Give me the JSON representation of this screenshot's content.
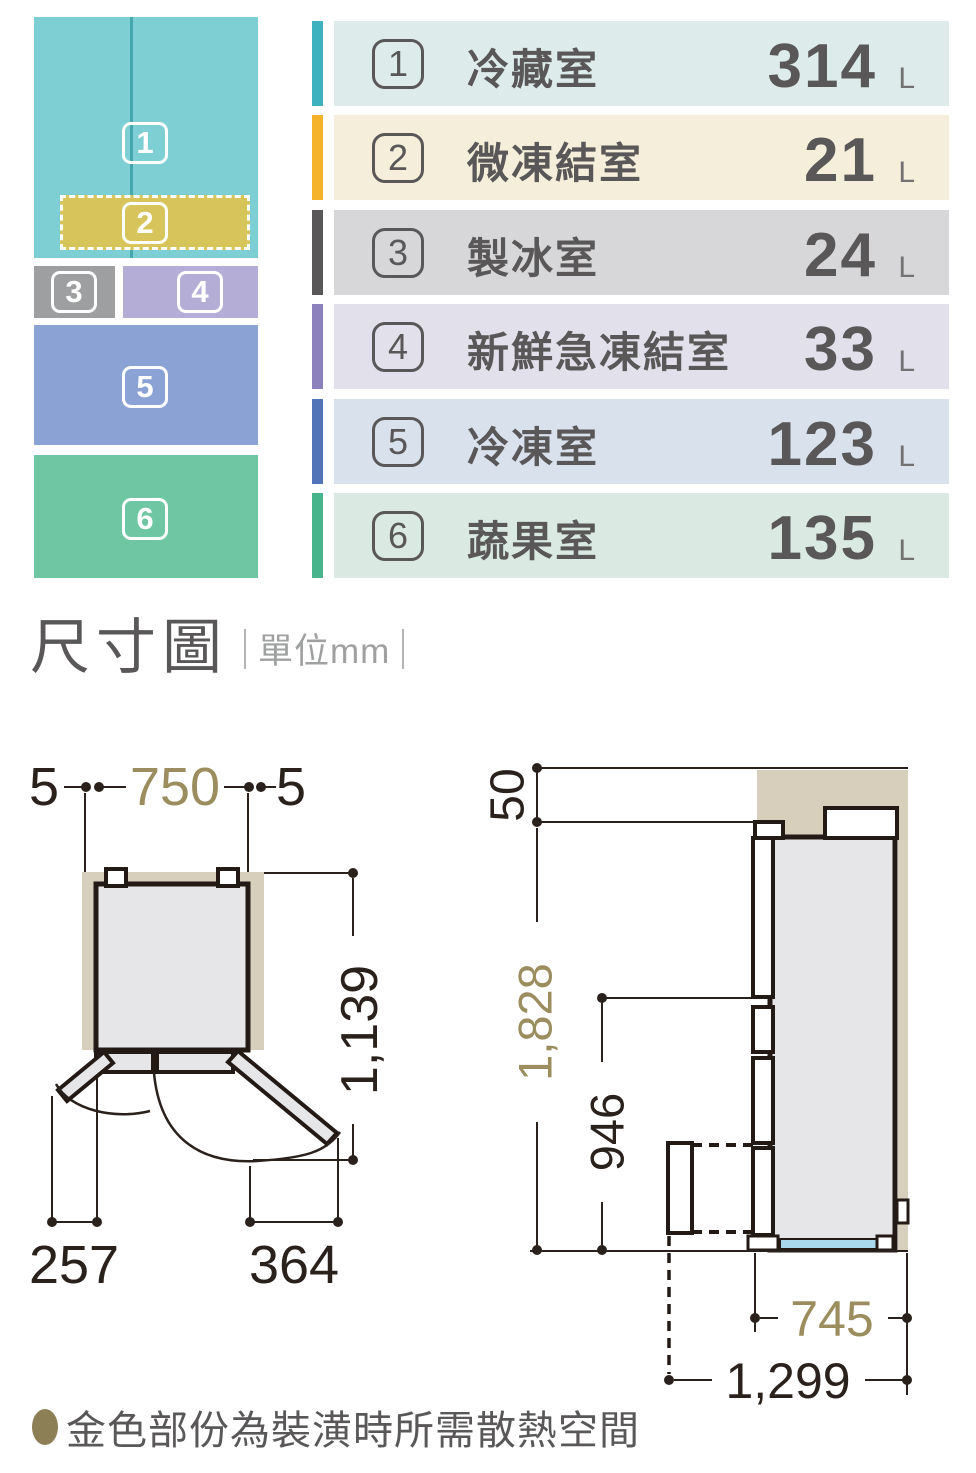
{
  "compartment_diagram": {
    "divider_color": "#45a6ad",
    "blocks": [
      {
        "num": "1",
        "color": "#7ecfd4"
      },
      {
        "num": "2",
        "color": "#d7c45b"
      },
      {
        "num": "3",
        "color": "#9e9fa0"
      },
      {
        "num": "4",
        "color": "#b4aed7"
      },
      {
        "num": "5",
        "color": "#8ba3d4"
      },
      {
        "num": "6",
        "color": "#6ec6a2"
      }
    ]
  },
  "legend": {
    "rows": [
      {
        "num": "1",
        "label": "冷藏室",
        "value": "314",
        "unit": "L",
        "accent_color": "#3eb3bf",
        "bg_color": "#ddeceb"
      },
      {
        "num": "2",
        "label": "微凍結室",
        "value": "21",
        "unit": "L",
        "accent_color": "#f5b32b",
        "bg_color": "#f5eeda"
      },
      {
        "num": "3",
        "label": "製冰室",
        "value": "24",
        "unit": "L",
        "accent_color": "#595757",
        "bg_color": "#d7d7d9"
      },
      {
        "num": "4",
        "label": "新鮮急凍結室",
        "value": "33",
        "unit": "L",
        "accent_color": "#8c80bd",
        "bg_color": "#e2e0ea"
      },
      {
        "num": "5",
        "label": "冷凍室",
        "value": "123",
        "unit": "L",
        "accent_color": "#5174b8",
        "bg_color": "#d9e1ec"
      },
      {
        "num": "6",
        "label": "蔬果室",
        "value": "135",
        "unit": "L",
        "accent_color": "#47b48b",
        "bg_color": "#daeae3"
      }
    ]
  },
  "dimension_section": {
    "title": "尺寸圖",
    "unit_label": "單位mm",
    "gold_color": "#9b8d5e",
    "clearance_color": "#d7cfbb",
    "line_color": "#2b211c",
    "front_view": {
      "side_gap_left": "5",
      "width": "750",
      "side_gap_right": "5",
      "open_depth": "1,139",
      "left_door_swing": "257",
      "right_door_swing": "364"
    },
    "side_view": {
      "top_clearance": "50",
      "height": "1,828",
      "drawer_height": "946",
      "depth": "745",
      "open_depth": "1,299"
    }
  },
  "footnote": {
    "text": "金色部份為裝潢時所需散熱空間",
    "bullet_color": "#8d7f55"
  }
}
